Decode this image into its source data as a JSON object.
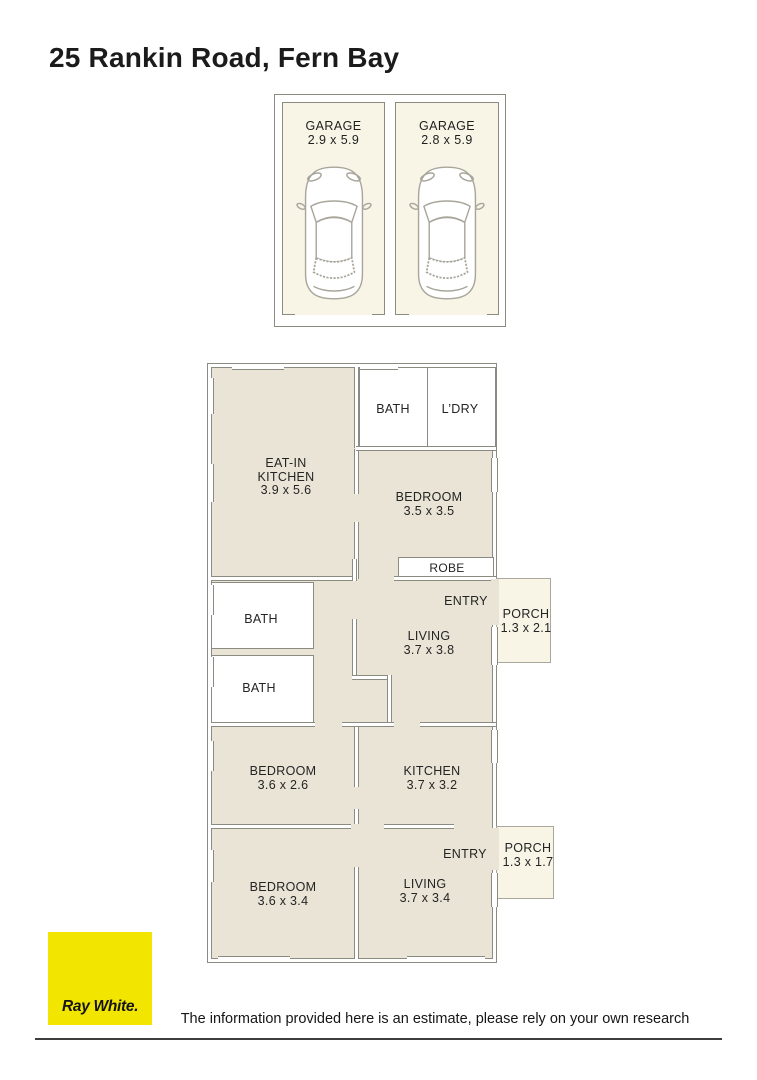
{
  "page": {
    "title": "25 Rankin Road, Fern Bay",
    "disclaimer": "The information provided here is an estimate, please rely on your own research"
  },
  "brand": {
    "name": "Ray White",
    "logo_text": "Ray White.",
    "logo_color": "#f2e600"
  },
  "garage": {
    "bays": [
      {
        "name": "GARAGE",
        "dims": "2.9 x 5.9"
      },
      {
        "name": "GARAGE",
        "dims": "2.8 x 5.9"
      }
    ]
  },
  "floorplan": {
    "colors": {
      "floor_fill": "#e9e4d6",
      "outdoor_fill": "#f8f5e7",
      "wall_line": "#8b8b82"
    },
    "rooms": [
      {
        "name": "EAT-IN KITCHEN",
        "dims": "3.9 x 5.6"
      },
      {
        "name": "BATH",
        "dims": ""
      },
      {
        "name": "L’DRY",
        "dims": ""
      },
      {
        "name": "BEDROOM",
        "dims": "3.5 x 3.5"
      },
      {
        "name": "ROBE",
        "dims": ""
      },
      {
        "name": "ENTRY",
        "dims": ""
      },
      {
        "name": "PORCH",
        "dims": "1.3 x 2.1"
      },
      {
        "name": "BATH",
        "dims": ""
      },
      {
        "name": "BATH",
        "dims": ""
      },
      {
        "name": "LIVING",
        "dims": "3.7 x 3.8"
      },
      {
        "name": "BEDROOM",
        "dims": "3.6 x 2.6"
      },
      {
        "name": "KITCHEN",
        "dims": "3.7 x 3.2"
      },
      {
        "name": "ENTRY",
        "dims": ""
      },
      {
        "name": "PORCH",
        "dims": "1.3 x 1.7"
      },
      {
        "name": "BEDROOM",
        "dims": "3.6 x 3.4"
      },
      {
        "name": "LIVING",
        "dims": "3.7 x 3.4"
      }
    ]
  }
}
